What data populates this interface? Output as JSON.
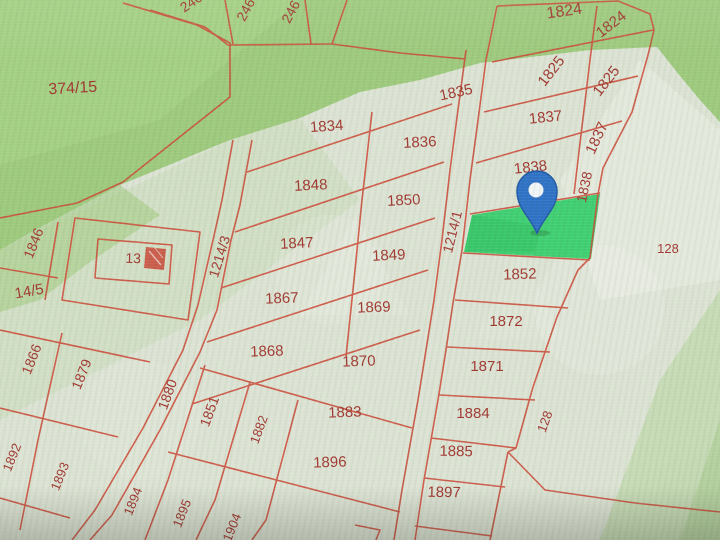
{
  "map": {
    "type": "cadastral-parcel-map",
    "colors": {
      "background_pale": "#dce3d4",
      "background_green": "#9dca7c",
      "line": "#cf4a38",
      "label": "#a43831",
      "highlight": "#35d06a",
      "pin_body": "#2d72c9",
      "pin_border": "#2059a8",
      "pin_hole": "#f2f5f7"
    },
    "highlighted_parcel": {
      "has_pin": true,
      "row_neighbor_label": "1838"
    },
    "roads": [
      {
        "label": "1214/3"
      },
      {
        "label": "1214/1"
      }
    ],
    "area_labels": [
      "374/15",
      "128",
      "14/5",
      "13"
    ],
    "labels": [
      {
        "text": "374/15",
        "x": 73,
        "y": 93,
        "rot": -3,
        "fs": 16
      },
      {
        "text": "2462",
        "x": 197,
        "y": 4,
        "rot": -35,
        "fs": 14
      },
      {
        "text": "246",
        "x": 250,
        "y": 12,
        "rot": -62,
        "fs": 14
      },
      {
        "text": "246",
        "x": 295,
        "y": 14,
        "rot": -62,
        "fs": 14
      },
      {
        "text": "1834",
        "x": 327,
        "y": 131,
        "rot": -4,
        "fs": 15
      },
      {
        "text": "1835",
        "x": 457,
        "y": 97,
        "rot": -12,
        "fs": 15
      },
      {
        "text": "1836",
        "x": 420,
        "y": 147,
        "rot": -3,
        "fs": 15
      },
      {
        "text": "1848",
        "x": 311,
        "y": 190,
        "rot": -3,
        "fs": 15
      },
      {
        "text": "1850",
        "x": 404,
        "y": 205,
        "rot": -3,
        "fs": 15
      },
      {
        "text": "1847",
        "x": 297,
        "y": 248,
        "rot": -3,
        "fs": 15
      },
      {
        "text": "1849",
        "x": 389,
        "y": 260,
        "rot": -3,
        "fs": 15
      },
      {
        "text": "1867",
        "x": 282,
        "y": 303,
        "rot": -2,
        "fs": 15
      },
      {
        "text": "1869",
        "x": 374,
        "y": 312,
        "rot": -2,
        "fs": 15
      },
      {
        "text": "1868",
        "x": 267,
        "y": 356,
        "rot": -2,
        "fs": 15
      },
      {
        "text": "1870",
        "x": 359,
        "y": 366,
        "rot": -2,
        "fs": 15
      },
      {
        "text": "1883",
        "x": 345,
        "y": 417,
        "rot": -2,
        "fs": 15
      },
      {
        "text": "1896",
        "x": 330,
        "y": 467,
        "rot": -2,
        "fs": 15
      },
      {
        "text": "1824",
        "x": 565,
        "y": 16,
        "rot": -8,
        "fs": 16
      },
      {
        "text": "1824",
        "x": 614,
        "y": 28,
        "rot": -38,
        "fs": 15
      },
      {
        "text": "1825",
        "x": 555,
        "y": 74,
        "rot": -52,
        "fs": 15
      },
      {
        "text": "1825",
        "x": 610,
        "y": 84,
        "rot": -52,
        "fs": 15
      },
      {
        "text": "1837",
        "x": 546,
        "y": 122,
        "rot": -6,
        "fs": 15
      },
      {
        "text": "1837",
        "x": 601,
        "y": 140,
        "rot": -65,
        "fs": 15
      },
      {
        "text": "1838",
        "x": 531,
        "y": 172,
        "rot": -6,
        "fs": 15
      },
      {
        "text": "1838",
        "x": 589,
        "y": 188,
        "rot": -78,
        "fs": 14
      },
      {
        "text": "1852",
        "x": 520,
        "y": 279,
        "rot": -2,
        "fs": 15
      },
      {
        "text": "1872",
        "x": 506,
        "y": 326,
        "rot": 0,
        "fs": 15
      },
      {
        "text": "1871",
        "x": 487,
        "y": 371,
        "rot": 0,
        "fs": 15
      },
      {
        "text": "1884",
        "x": 473,
        "y": 418,
        "rot": 0,
        "fs": 15
      },
      {
        "text": "1885",
        "x": 456,
        "y": 456,
        "rot": 1,
        "fs": 15
      },
      {
        "text": "1897",
        "x": 444,
        "y": 497,
        "rot": 1,
        "fs": 15
      },
      {
        "text": "128",
        "x": 668,
        "y": 253,
        "rot": 0,
        "fs": 13
      },
      {
        "text": "128",
        "x": 549,
        "y": 423,
        "rot": -70,
        "fs": 13
      },
      {
        "text": "1214/3",
        "x": 224,
        "y": 258,
        "rot": -73,
        "fs": 14
      },
      {
        "text": "1214/1",
        "x": 457,
        "y": 233,
        "rot": -76,
        "fs": 14
      },
      {
        "text": "13",
        "x": 133,
        "y": 263,
        "rot": 2,
        "fs": 14
      },
      {
        "text": "14/5",
        "x": 30,
        "y": 296,
        "rot": -10,
        "fs": 15
      },
      {
        "text": "1846",
        "x": 38,
        "y": 245,
        "rot": -68,
        "fs": 14
      },
      {
        "text": "1866",
        "x": 36,
        "y": 361,
        "rot": -68,
        "fs": 14
      },
      {
        "text": "1879",
        "x": 86,
        "y": 376,
        "rot": -68,
        "fs": 14
      },
      {
        "text": "1880",
        "x": 172,
        "y": 396,
        "rot": -70,
        "fs": 14
      },
      {
        "text": "1851",
        "x": 214,
        "y": 413,
        "rot": -70,
        "fs": 14
      },
      {
        "text": "1882",
        "x": 263,
        "y": 431,
        "rot": -70,
        "fs": 13
      },
      {
        "text": "1892",
        "x": 16,
        "y": 459,
        "rot": -68,
        "fs": 13
      },
      {
        "text": "1893",
        "x": 64,
        "y": 478,
        "rot": -68,
        "fs": 13
      },
      {
        "text": "1894",
        "x": 137,
        "y": 503,
        "rot": -68,
        "fs": 13
      },
      {
        "text": "1895",
        "x": 186,
        "y": 515,
        "rot": -68,
        "fs": 13
      },
      {
        "text": "1904",
        "x": 236,
        "y": 529,
        "rot": -68,
        "fs": 13
      }
    ]
  }
}
